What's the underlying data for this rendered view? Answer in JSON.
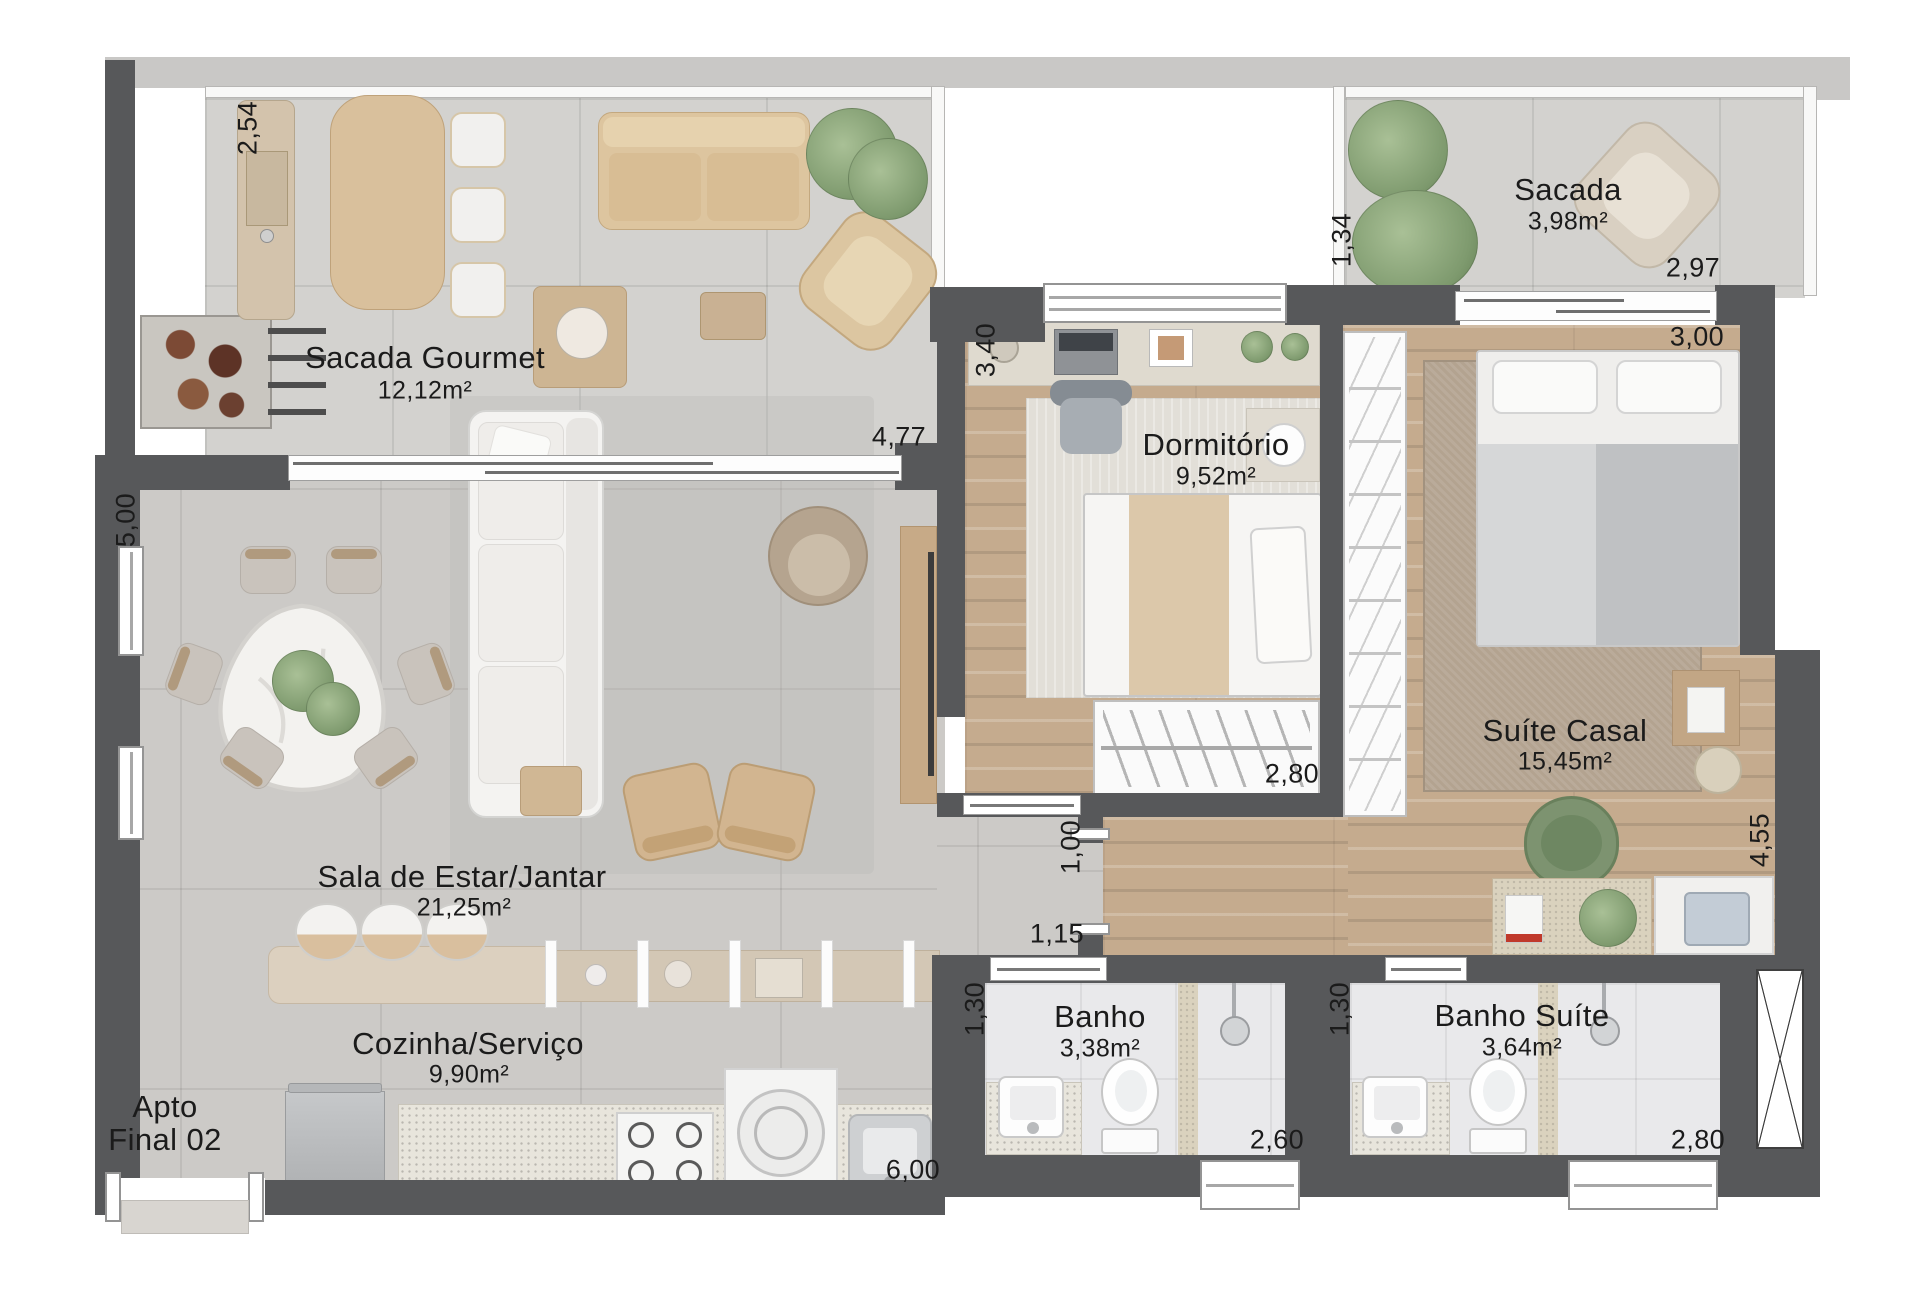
{
  "apartment": {
    "line1": "Apto",
    "line2": "Final 02"
  },
  "rooms": {
    "sacada_gourmet": {
      "name": "Sacada Gourmet",
      "area": "12,12m²"
    },
    "sacada": {
      "name": "Sacada",
      "area": "3,98m²"
    },
    "dormitorio": {
      "name": "Dormitório",
      "area": "9,52m²"
    },
    "suite_casal": {
      "name": "Suíte Casal",
      "area": "15,45m²"
    },
    "sala": {
      "name": "Sala de Estar/Jantar",
      "area": "21,25m²"
    },
    "cozinha": {
      "name": "Cozinha/Serviço",
      "area": "9,90m²"
    },
    "banho": {
      "name": "Banho",
      "area": "3,38m²"
    },
    "banho_suite": {
      "name": "Banho Suíte",
      "area": "3,64m²"
    }
  },
  "dims": [
    "2,54",
    "1,34",
    "2,97",
    "3,00",
    "4,77",
    "5,00",
    "3,40",
    "2,80",
    "1,00",
    "1,15",
    "1,30",
    "2,60",
    "1,30",
    "2,80",
    "4,55",
    "6,00"
  ]
}
